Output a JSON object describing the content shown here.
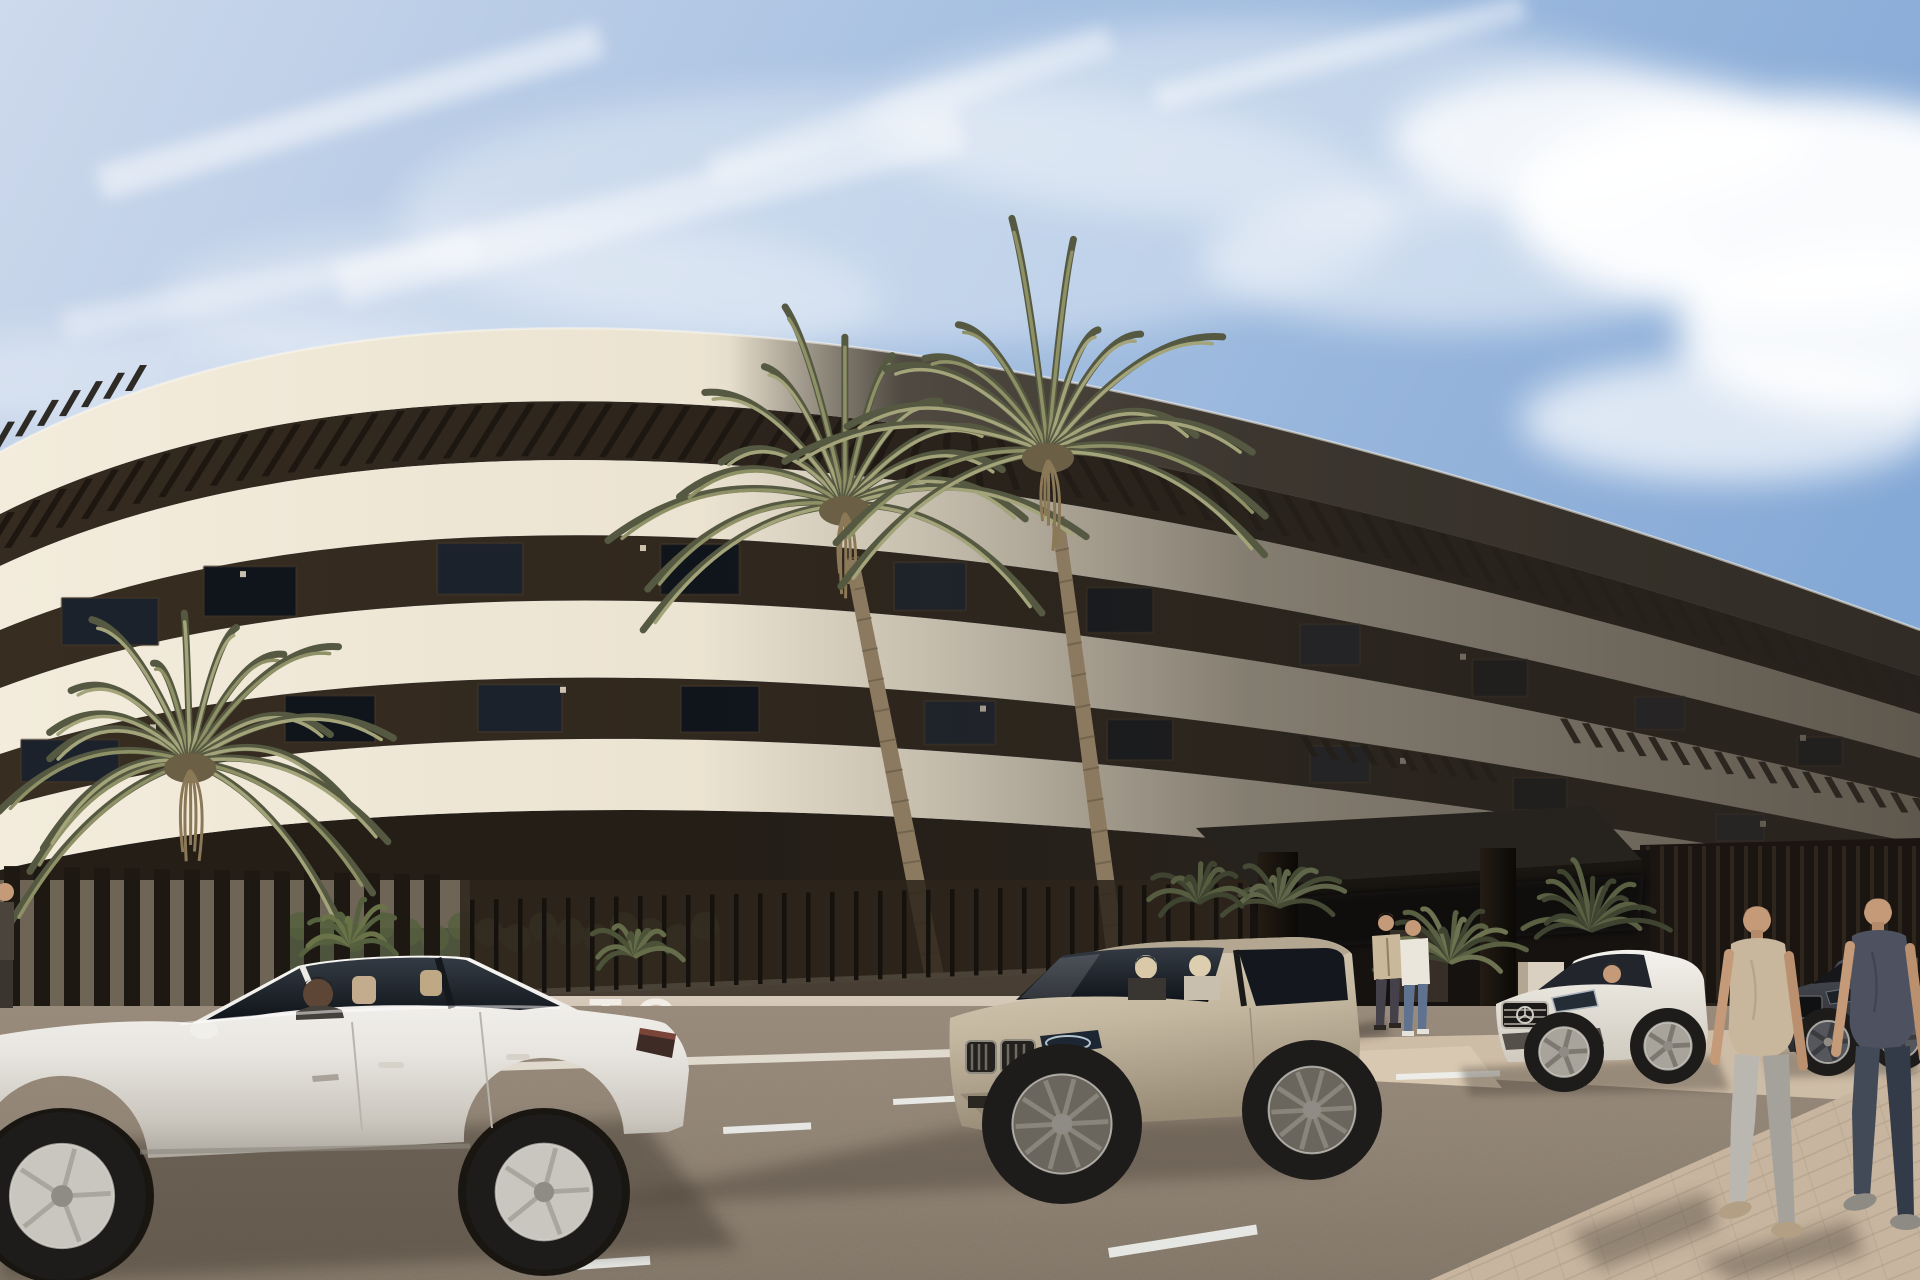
{
  "scene": {
    "type": "architectural-render",
    "description": "New-build modern apartment complex with curved cream balcony bands, dark recessed floors, pergola louvers, palm trees, slatted perimeter fence, parked cars and pedestrians under a blue sky",
    "wall_sign_text": "TO",
    "palette": {
      "sky_top": "#cdd9ec",
      "sky_mid": "#a9c2e2",
      "sky_right": "#85a9d6",
      "cloud": "#ffffff",
      "band_light_1": "#f3ecdc",
      "band_light_2": "#e9e0cd",
      "band_deep": "#d8cdb8",
      "dark_floor_1": "#382d21",
      "dark_floor_2": "#241f18",
      "window_glass": "#10151c",
      "window_glass_hi": "#1c222c",
      "louver": "#1c1610",
      "shade_overlay": "#2b2620",
      "fascia_shadow": "#36312a",
      "canopy_top": "#26231e",
      "canopy_face": "#191511",
      "pillar": "#17130e",
      "fence_wall": "#d9cdbd",
      "fence_wall_low": "#bfb09e",
      "fence_slat": "#1d1811",
      "fence_back": "#6e6557",
      "railing": "#15110c",
      "hedge": "#49503a",
      "frond_dark": "#565941",
      "frond_mid": "#8e9066",
      "frond_hi": "#a3a47a",
      "trunk": "#8b7a60",
      "trunk_dark": "#6e5f4a",
      "asphalt": "#8d8071",
      "asphalt_light": "#a39483",
      "road_shadow": "#4c4338",
      "curb": "#e8e2d6",
      "sidewalk": "#cdbca6",
      "paver": "#c7b59f",
      "paver_line": "#b3a28c",
      "marking": "#eef0ee",
      "skin": "#c59a78",
      "skin_dark": "#5d4636"
    },
    "vehicles": [
      {
        "name": "white-sedan",
        "kind": "sedan parked side-on, driver inside",
        "body": "#efede8",
        "glass": "#232830"
      },
      {
        "name": "champagne-suv",
        "kind": "SUV front three-quarter, two occupants",
        "body": "#cfc3ae",
        "glass": "#20252d"
      },
      {
        "name": "white-coupe",
        "kind": "white Mercedes-style sedan, driver inside",
        "body": "#ebe9e3",
        "glass": "#22262c"
      },
      {
        "name": "dark-sedan",
        "kind": "dark grey sedan at far right",
        "body": "#43464c",
        "glass": "#15171b"
      }
    ],
    "people": [
      {
        "name": "standing-man-beige",
        "clothes": "#c9b899",
        "pants": "#44414a"
      },
      {
        "name": "standing-man-white",
        "clothes": "#eae6dc",
        "pants": "#5f7391"
      },
      {
        "name": "walking-man-tan",
        "clothes": "#c8b79d",
        "pants": "#b6b3ad"
      },
      {
        "name": "walking-man-dark",
        "clothes": "#4d5160",
        "pants": "#3c4350"
      },
      {
        "name": "partial-person-left-edge",
        "clothes": "#4a443c",
        "pants": "#3a352e"
      }
    ]
  }
}
